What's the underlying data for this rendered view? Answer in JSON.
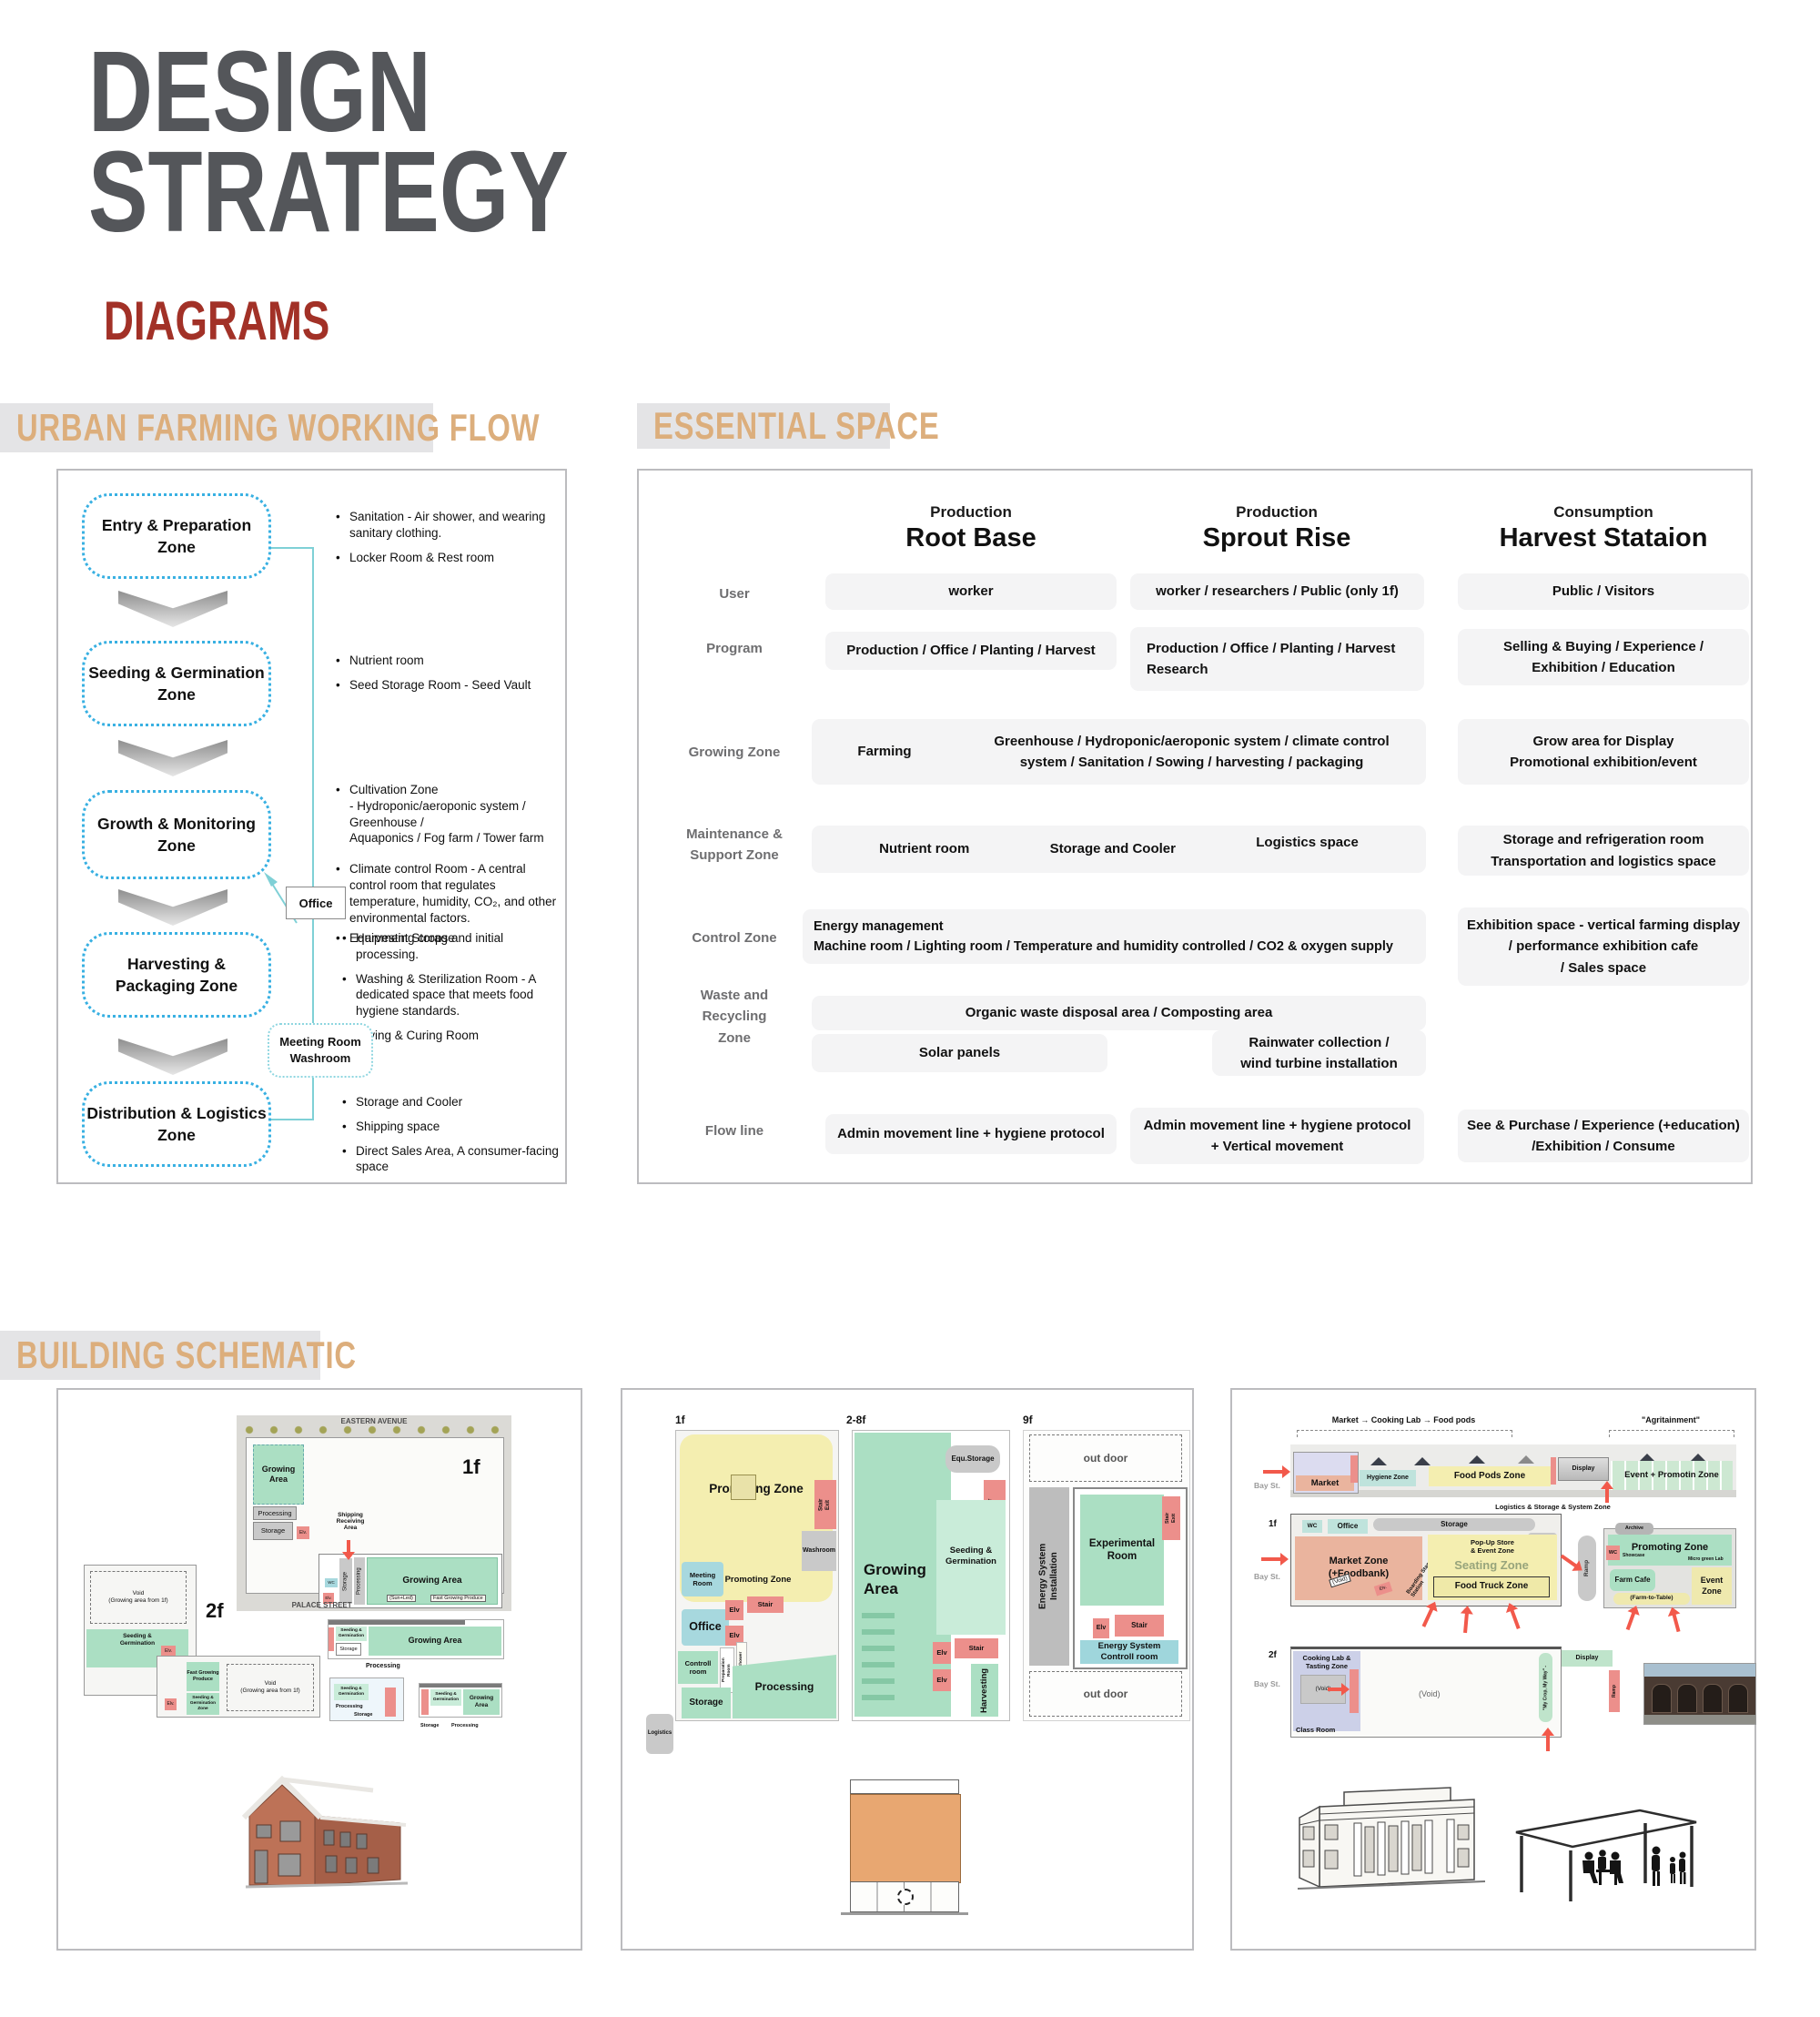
{
  "page": {
    "title": "DESIGN\nSTRATEGY",
    "subtitle": "DIAGRAMS"
  },
  "bars": {
    "flow": "URBAN FARMING WORKING FLOW",
    "space": "ESSENTIAL SPACE",
    "schematic": "BUILDING SCHEMATIC"
  },
  "flow": {
    "zones": [
      {
        "label": "Entry & Preparation\nZone"
      },
      {
        "label": "Seeding & Germination\nZone"
      },
      {
        "label": "Growth & Monitoring\nZone"
      },
      {
        "label": "Harvesting &\nPackaging Zone"
      },
      {
        "label": "Distribution & Logistics\nZone"
      }
    ],
    "office": "Office",
    "meeting": "Meeting Room\nWashroom",
    "notes1": [
      "Sanitation - Air shower, and wearing sanitary clothing.",
      "Locker Room & Rest room"
    ],
    "notes2": [
      "Nutrient room",
      "Seed Storage Room - Seed Vault"
    ],
    "notes3": [
      "Cultivation Zone\n- Hydroponic/aeroponic system / Greenhouse /\n   Aquaponics / Fog farm / Tower farm",
      "Climate control Room - A central control room that regulates temperature, humidity, CO₂, and other environmental factors.",
      "Equipment Storage"
    ],
    "notes4": [
      "Harvesting crops and initial processing.",
      "Washing & Sterilization Room -  A dedicated space that meets food hygiene standards.",
      "Drying & Curing Room"
    ],
    "notes5": [
      "Storage and Cooler",
      "Shipping space",
      "Direct Sales Area,   A consumer-facing space"
    ]
  },
  "table": {
    "columns": [
      {
        "category": "Production",
        "name": "Root Base"
      },
      {
        "category": "Production",
        "name": "Sprout Rise"
      },
      {
        "category": "Consumption",
        "name": "Harvest Stataion"
      }
    ],
    "labels": {
      "user": "User",
      "program": "Program",
      "growing": "Growing Zone",
      "maintenance": "Maintenance &\nSupport Zone",
      "control": "Control Zone",
      "waste": "Waste and\nRecycling\nZone",
      "flowline": "Flow line"
    },
    "user": [
      "worker",
      "worker / researchers / Public (only 1f)",
      "Public / Visitors"
    ],
    "program": [
      "Production / Office / Planting / Harvest",
      "Production / Office / Planting / Harvest\nResearch",
      "Selling & Buying / Experience /\nExhibition / Education"
    ],
    "growing": {
      "farming": "Farming",
      "span": "Greenhouse / Hydroponic/aeroponic system / climate control\nsystem / Sanitation / Sowing / harvesting / packaging",
      "col3": "Grow area for Display\nPromotional exhibition/event"
    },
    "maintenance": {
      "items": [
        "Nutrient room",
        "Storage and Cooler",
        "Logistics space"
      ],
      "col3": "Storage and refrigeration room\nTransportation and logistics space"
    },
    "control": {
      "span": "Energy management\n    Machine room / Lighting room / Temperature and humidity controlled / CO2 & oxygen supply",
      "col3": "Exhibition space - vertical farming display\n/ performance exhibition cafe\n/ Sales space"
    },
    "waste": {
      "span": "Organic waste disposal area  / Composting area",
      "solar": "Solar panels",
      "rain": "Rainwater collection /\nwind turbine installation"
    },
    "flowline": [
      "Admin movement line + hygiene protocol",
      "Admin movement line + hygiene protocol\n+ Vertical movement",
      "See & Purchase  / Experience (+education)\n/Exhibition / Consume"
    ]
  },
  "s1": {
    "street_top": "EASTERN AVENUE",
    "street_bottom": "PALACE STREET",
    "f1": "1f",
    "f2": "2f",
    "growing1": "Growing\nArea",
    "processing1": "Processing",
    "storage1": "Storage",
    "elv": "Elv.",
    "shipping": "Shipping\nReceiving\nArea",
    "wc": "WC",
    "storage_v": "Storage",
    "processing_v": "Processing",
    "growing2": "Growing Area",
    "sunled": "(Sun+Led)",
    "fastgrow": "Fast Growing Produce",
    "void": "Void\n(Growing area from 1f)",
    "seeding": "Seeding &\nGermination",
    "fastgrow2": "Fast Growing\nProduce",
    "seedzone": "Seeding &\nGermination\nZone",
    "sec_grow": "Growing Area",
    "sec_seed": "Seeding &\nGermination",
    "sec_storage": "Storage",
    "sec_proc": "Processing",
    "sec3_grow": "Growing\nArea"
  },
  "s2": {
    "f1": "1f",
    "f28": "2-8f",
    "f9": "9f",
    "promoting": "Promoting Zone",
    "stairexit": "Stair\nExit",
    "washroom": "Washroom",
    "meeting": "Meeting\nRoom",
    "office": "Office",
    "elv": "Elv",
    "stair": "Stair",
    "controll": "Controll\nroom",
    "prep": "Preparation\nRoom",
    "airshower": "Air Shower",
    "storage": "Storage",
    "processing": "Processing",
    "logistics": "Logistics",
    "growing": "Growing\nArea",
    "equ": "Equ.Storage",
    "seeding": "Seeding &\nGermination",
    "harvesting": "Harvesting",
    "outdoor": "out door",
    "energyinstall": "Energy System\nInstallation",
    "experimental": "Experimental\nRoom",
    "energycontrol": "Energy System\nControll room"
  },
  "s3": {
    "bracket1": "Market → Cooking Lab → Food pods",
    "bracket2": "\"Agritainment\"",
    "bay": "Bay St.",
    "market": "Market",
    "hygiene": "Hygiene Zone",
    "foodpods": "Food Pods Zone",
    "display": "Display",
    "eventpromotin": "Event + Promotin Zone",
    "lss": "Logistics & Storage & System Zone",
    "f1": "1f",
    "f2": "2f",
    "wc": "WC",
    "office": "Office",
    "storage": "Storage",
    "logistics": "Logistics",
    "marketzone": "Market Zone\n(+Foodbank)",
    "voidtag": "(Void)",
    "boarding": "Boarding Stamp Station",
    "popup": "Pop-Up Store\n& Event Zone",
    "seating": "Seating Zone",
    "foodtruck": "Food Truck Zone",
    "ramp": "Ramp",
    "archive": "Archive",
    "promoting": "Promoting Zone",
    "showcase": "Showcase",
    "microgreen": "Micro green Lab",
    "farmcafe": "Farm Cafe",
    "farmtable": "(Farm-to-Table)",
    "eventzone": "Event\nZone",
    "cookinglab": "Cooking Lab &\nTasting Zone",
    "void2": "(Void)",
    "classroom": "Class Room",
    "mycrop": "\"My Crop, My Way\" -",
    "elv": "Elv."
  }
}
